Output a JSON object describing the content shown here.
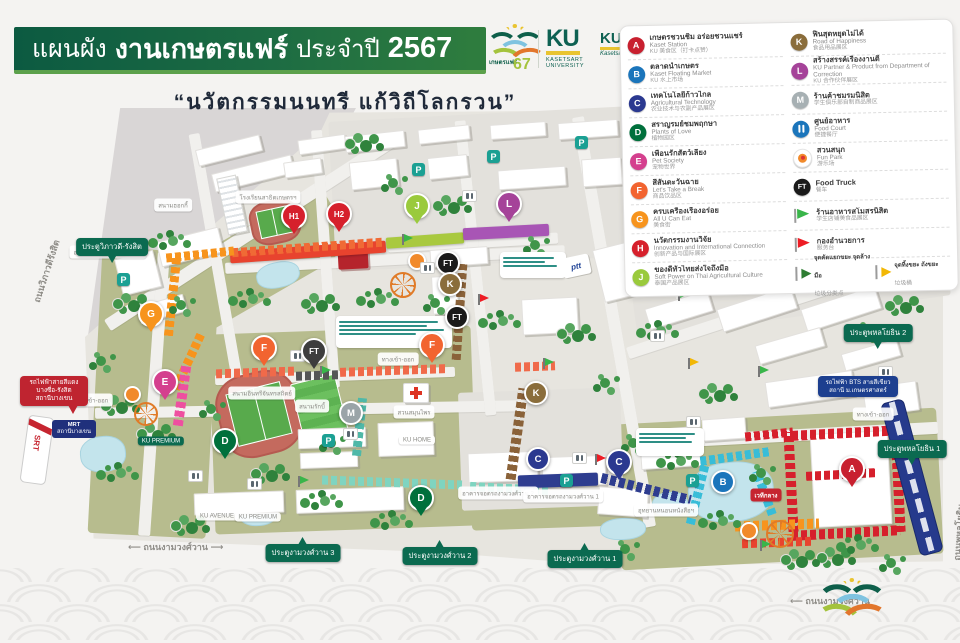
{
  "header": {
    "title_prefix": "แผนผัง",
    "title_main": "งานเกษตรแฟร์",
    "title_suffix": "ประจำปี",
    "title_year": "2567",
    "subtitle": "“นวัตกรรมนนทรี แก้วิถีโลกรวน”",
    "fair_logo": {
      "name": "เกษตรแฟร์",
      "year": "67"
    },
    "ku_logo": {
      "ku": "KU",
      "line1": "KASETSART",
      "line2": "UNIVERSITY"
    },
    "ku_logo_2": {
      "ku": "KU",
      "script": "Kasetsart University"
    }
  },
  "legend": {
    "left": [
      {
        "letter": "A",
        "color": "#c8202f",
        "thai": "เกษตรชวนชิม อร่อยชวนแชร์",
        "eng": "Kaset Station",
        "zh": "KU 美食区（打卡点赞）"
      },
      {
        "letter": "B",
        "color": "#1b75bb",
        "thai": "ตลาดน้ำเกษตร",
        "eng": "Kaset Floating Market",
        "zh": "KU 水上市场"
      },
      {
        "letter": "C",
        "color": "#2b3990",
        "thai": "เทคโนโลยีก้าวไกล",
        "eng": "Agricultural Technology",
        "zh": "农业技术与农副产品展区"
      },
      {
        "letter": "D",
        "color": "#00703c",
        "thai": "สราญรมย์ชมพฤกษา",
        "eng": "Plants of Love",
        "zh": "植物园区"
      },
      {
        "letter": "E",
        "color": "#d4408e",
        "thai": "เพื่อนรักสัตว์เลี้ยง",
        "eng": "Pet Society",
        "zh": "宠物世界"
      },
      {
        "letter": "F",
        "color": "#f26430",
        "thai": "สีสันตะวันฉาย",
        "eng": "Let's Take a Break",
        "zh": "商品饮品区"
      },
      {
        "letter": "G",
        "color": "#f7941d",
        "thai": "ครบเครื่องเรื่องอร่อย",
        "eng": "All U Can Eat",
        "zh": "美食街"
      },
      {
        "letter": "H",
        "color": "#d6202c",
        "thai": "นวัตกรรมงานวิจัย",
        "eng": "Innovation and International Connection",
        "zh": "创新产品与国际展区"
      },
      {
        "letter": "J",
        "color": "#9aca3c",
        "thai": "ของดีทั่วไทยส่งใจถึงมือ",
        "eng": "Soft Power on Thai Agricultural Culture",
        "zh": "泰国产品展区"
      }
    ],
    "right": [
      {
        "letter": "K",
        "color": "#8a6d3b",
        "thai": "ฟินสุดหยุดไม่ได้",
        "eng": "Road of Happiness",
        "zh": "食品用品展区"
      },
      {
        "letter": "L",
        "color": "#a54399",
        "thai": "สร้างสรรค์เรื่องงานดี",
        "eng": "KU Partner & Product from Department of Correction",
        "zh": "KU 合作伙伴展区"
      },
      {
        "letter": "M",
        "color": "#a7b0b3",
        "thai": "ร้านค้าชมรมนิสิต",
        "eng": "",
        "zh": "学生俱乐部自制商品展区"
      },
      {
        "icon": "foodcourt",
        "color": "#1b75bb",
        "thai": "ศูนย์อาหาร",
        "eng": "Food Court",
        "zh": "便捷餐厅"
      },
      {
        "icon": "funpark",
        "color": "#f7941d",
        "thai": "สวนสนุก",
        "eng": "Fun Park",
        "zh": "游乐场"
      },
      {
        "icon": "ft",
        "color": "#1a1a1a",
        "thai": "",
        "eng": "Food Truck",
        "zh": "餐车"
      },
      {
        "icon": "flag-green",
        "color": "#39b54a",
        "thai": "ร้านอาหารสโมสรนิสิต",
        "eng": "",
        "zh": "学生店铺美食品展区"
      },
      {
        "icon": "flag-red",
        "color": "#ed1c24",
        "thai": "กองอำนวยการ",
        "eng": "",
        "zh": "服务台"
      },
      {
        "icon": "pennants",
        "items": [
          {
            "color": "#2e7d32",
            "thai": "จุดคัดแยกขยะ จุดล้างมือ",
            "zh": "垃圾分类点"
          },
          {
            "color": "#f2b705",
            "thai": "จุดทิ้งขยะ ถังขยะ",
            "zh": "垃圾桶"
          }
        ]
      }
    ]
  },
  "map": {
    "markers": [
      {
        "label": "G",
        "color": "#f7941d"
      },
      {
        "label": "E",
        "color": "#d4408e"
      },
      {
        "label": "F",
        "color": "#f26430"
      },
      {
        "label": "F",
        "color": "#f26430"
      },
      {
        "label": "FT",
        "color": "#3d3d3d"
      },
      {
        "label": "FT",
        "color": "#1a1a1a"
      },
      {
        "label": "FT",
        "color": "#1a1a1a"
      },
      {
        "label": "H1",
        "color": "#d6202c"
      },
      {
        "label": "H2",
        "color": "#d6202c"
      },
      {
        "label": "J",
        "color": "#9aca3c"
      },
      {
        "label": "L",
        "color": "#a54399"
      },
      {
        "label": "K",
        "color": "#8a6d3b"
      },
      {
        "label": "K",
        "color": "#8a6d3b"
      },
      {
        "label": "M",
        "color": "#9aa4a8"
      },
      {
        "label": "D",
        "color": "#00703c"
      },
      {
        "label": "D",
        "color": "#00703c"
      },
      {
        "label": "C",
        "color": "#2b3990"
      },
      {
        "label": "C",
        "color": "#2b3990"
      },
      {
        "label": "B",
        "color": "#1b75bb"
      },
      {
        "label": "A",
        "color": "#c8202f"
      }
    ],
    "gates": [
      "ประตูวิภาวดี-รังสิต",
      "ประตูงามวงศ์วาน 3",
      "ประตูงามวงศ์วาน 2",
      "ประตูงามวงศ์วาน 1",
      "ประตูพหลโยธิน 2",
      "ประตูพหลโยธิน 1"
    ],
    "labels": [
      "สนามฮอกกี้",
      "โรงเรียนสาธิตเกษตรฯ",
      "อาคารจอดรถวิภาวดี-รังสิต",
      "สนามอินทรีจันทรสถิตย์",
      "สนามรักบี้",
      "สวนสมุนไพร",
      "KU HOME",
      "KU AVENUE",
      "KU PREMIUM",
      "อาคารจอดรถงามวงศ์วาน 2",
      "อาคารจอดรถงามวงศ์วาน 1",
      "อุทยานหนอนหนังสือฯ",
      "ทางเข้า-ออก",
      "ทางเข้า-ออก",
      "ทางเข้า-ออก",
      "เวทีกลาง",
      "KU PREMIUM"
    ],
    "road_labels": [
      "ถนนงามวงศ์วาน",
      "ถนนงามวงศ์วาน",
      "ถนนวิภาวดีรังสิต",
      "ถนนพหลโยธิน"
    ],
    "signs": {
      "red_line": [
        "รถไฟฟ้าสายสีแดง",
        "บางซื่อ-รังสิต",
        "สถานีบางเขน"
      ],
      "mrt": [
        "MRT",
        "สถานีบางเขน"
      ],
      "bts": [
        "รถไฟฟ้า BTS สายสีเขียว",
        "สถานี ม.เกษตรศาสตร์"
      ],
      "ptt": "ptt",
      "srt": "SRT"
    }
  }
}
